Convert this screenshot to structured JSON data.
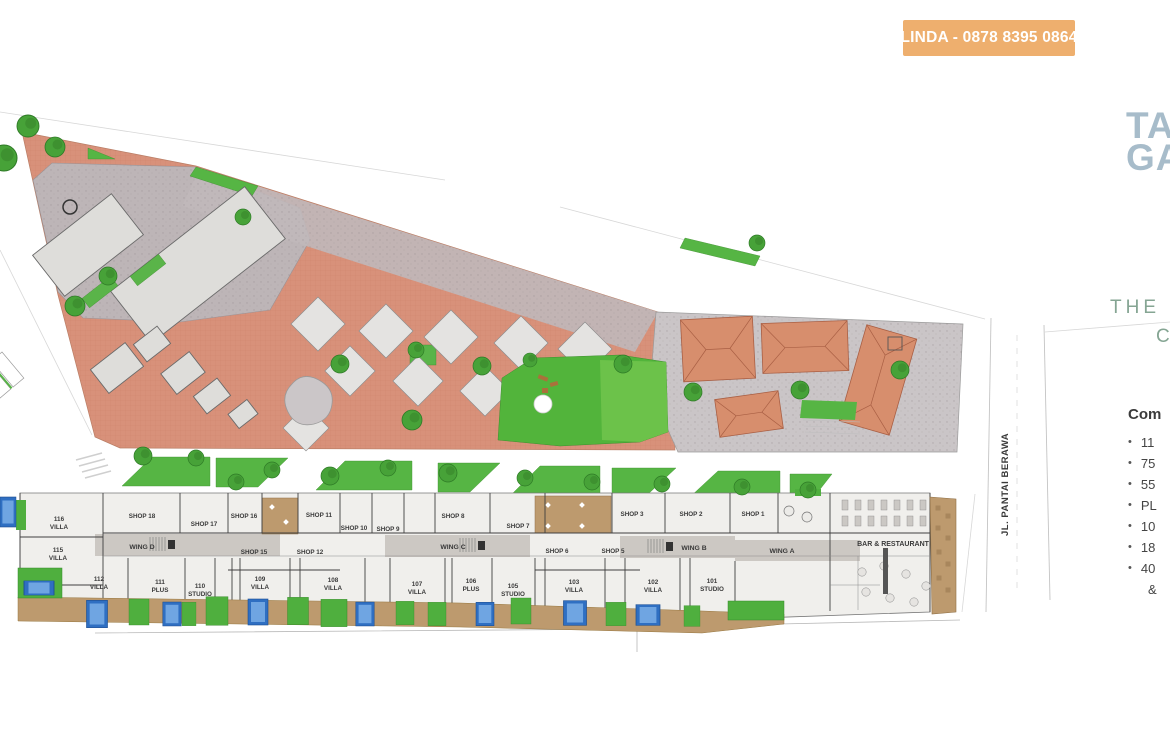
{
  "badge": {
    "contact": "LINDA - 0878 8395 0864"
  },
  "brand": {
    "logo_line1": "TA",
    "logo_line2": "GA",
    "tagline_line1": "THE",
    "tagline_line2": "C"
  },
  "road": {
    "name": "JL. PANTAI BERAWA"
  },
  "summary": {
    "heading": "Com",
    "items": [
      "11",
      "75",
      "55",
      "PL",
      "10",
      "18",
      "40"
    ],
    "continuation": "&"
  },
  "plan": {
    "shops": {
      "s18": "SHOP 18",
      "s17": "SHOP 17",
      "s16": "SHOP 16",
      "s15": "SHOP 15",
      "s12": "SHOP 12",
      "s11": "SHOP 11",
      "s10": "SHOP 10",
      "s9": "SHOP 9",
      "s8": "SHOP 8",
      "s7": "SHOP 7",
      "s6": "SHOP 6",
      "s5": "SHOP 5",
      "s3": "SHOP 3",
      "s2": "SHOP 2",
      "s1": "SHOP 1"
    },
    "wings": {
      "a": "WING A",
      "b": "WING B",
      "c": "WING C",
      "d": "WING D"
    },
    "venue": {
      "bar": "BAR & RESTAURANT"
    },
    "units": {
      "u116": {
        "num": "116",
        "type": "VILLA"
      },
      "u115": {
        "num": "115",
        "type": "VILLA"
      },
      "u112": {
        "num": "112",
        "type": "VILLA"
      },
      "u111": {
        "num": "111",
        "type": "PLUS"
      },
      "u110": {
        "num": "110",
        "type": "STUDIO"
      },
      "u109": {
        "num": "109",
        "type": "VILLA"
      },
      "u108": {
        "num": "108",
        "type": "VILLA"
      },
      "u107": {
        "num": "107",
        "type": "VILLA"
      },
      "u106": {
        "num": "106",
        "type": "PLUS"
      },
      "u105": {
        "num": "105",
        "type": "STUDIO"
      },
      "u103": {
        "num": "103",
        "type": "VILLA"
      },
      "u102": {
        "num": "102",
        "type": "VILLA"
      },
      "u101": {
        "num": "101",
        "type": "STUDIO"
      }
    }
  },
  "colors": {
    "badge_bg": "#EEAF6E",
    "logo": "#A7BCCA",
    "tagline": "#85A593",
    "plaza": "#D8917A",
    "pavement": "#BDB5B7",
    "roof_terracotta": "#D78E6D",
    "lawn": "#56B544",
    "pool": "#2F6FC2",
    "deck": "#BD9A6E",
    "label_text": "#3A3A3A"
  }
}
